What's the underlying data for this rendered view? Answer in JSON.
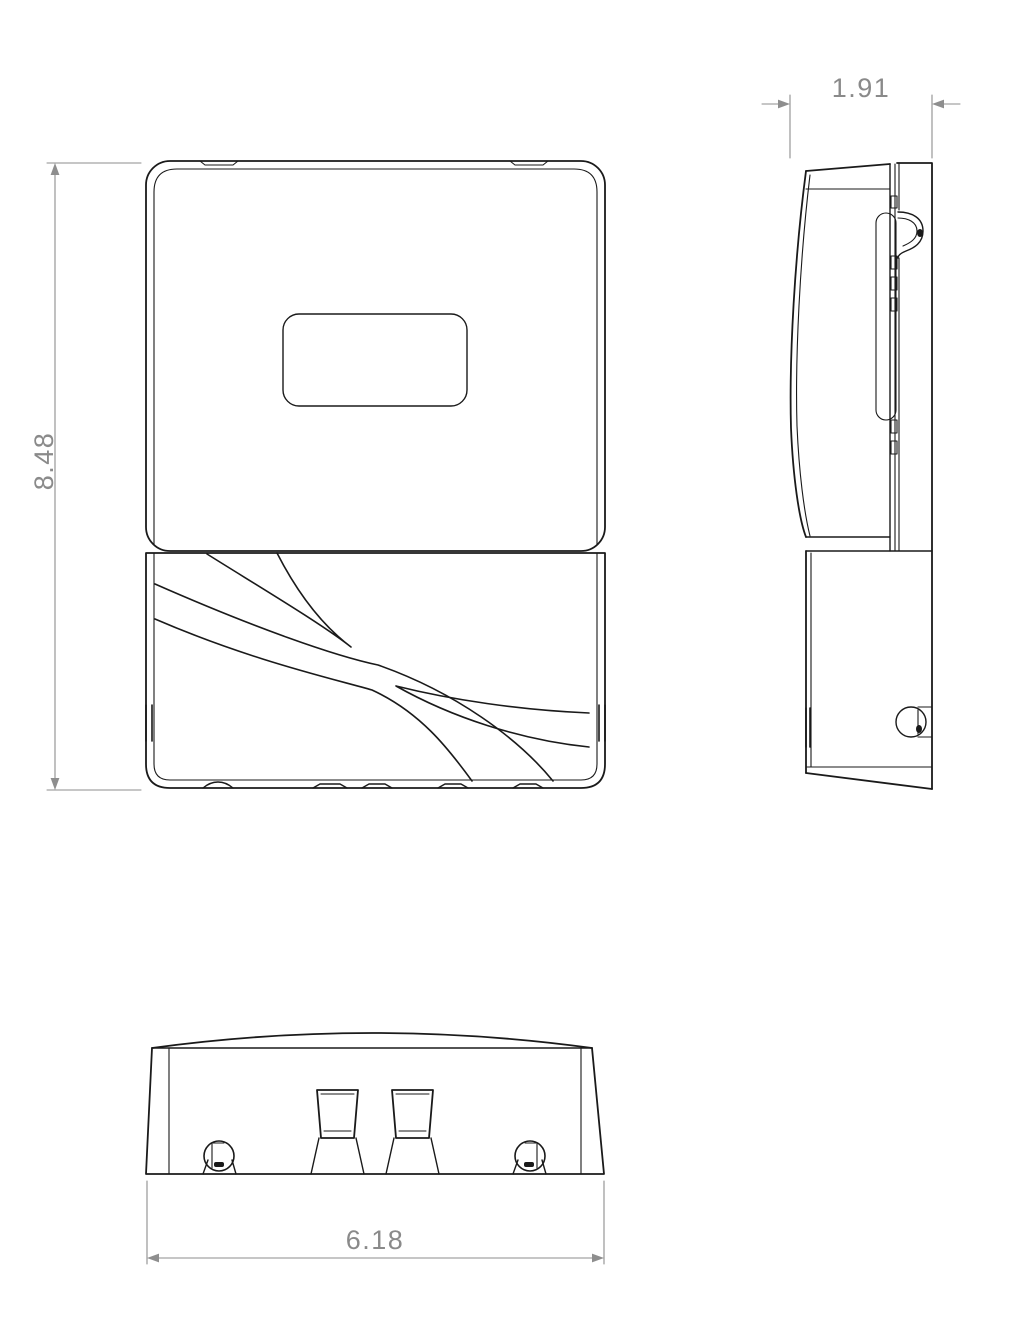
{
  "dimensions": {
    "height": {
      "value": "8.48"
    },
    "depth": {
      "value": "1.91"
    },
    "width": {
      "value": "6.18"
    }
  },
  "colors": {
    "line": "#1a1a1a",
    "dimension_line": "#8e8e8e",
    "dimension_text": "#8a8a8a",
    "background": "#ffffff"
  }
}
